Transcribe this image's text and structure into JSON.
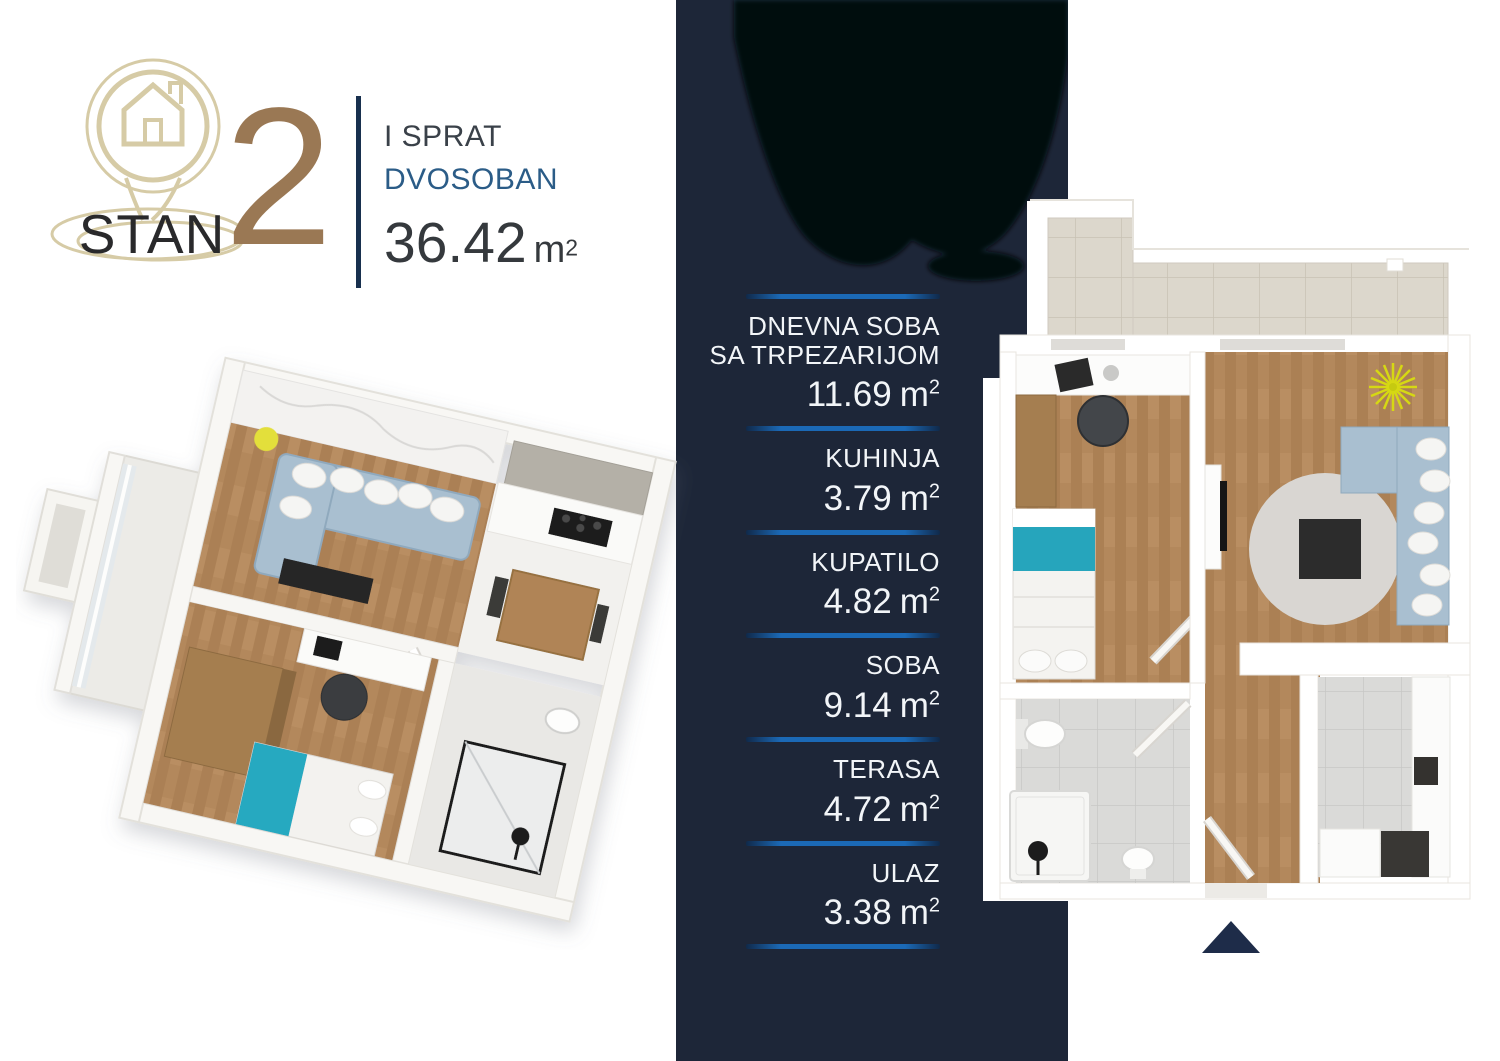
{
  "header": {
    "brand": "STAN",
    "unit_number": "2",
    "floor_label": "I SPRAT",
    "layout_label": "DVOSOBAN",
    "total_area": "36.42",
    "area_unit": "m",
    "area_exp": "2"
  },
  "area_unit": "m",
  "area_exp": "2",
  "rooms": [
    {
      "lines": [
        "DNEVNA SOBA",
        "SA TRPEZARIJOM"
      ],
      "area": "11.69"
    },
    {
      "lines": [
        "KUHINJA"
      ],
      "area": "3.79"
    },
    {
      "lines": [
        "KUPATILO"
      ],
      "area": "4.82"
    },
    {
      "lines": [
        "SOBA"
      ],
      "area": "9.14"
    },
    {
      "lines": [
        "TERASA"
      ],
      "area": "4.72"
    },
    {
      "lines": [
        "ULAZ"
      ],
      "area": "3.38"
    }
  ],
  "colors": {
    "column_navy": "#1d2638",
    "divider_blue": "#1b69b6",
    "unit_number_brown": "#9a7854",
    "logo_beige": "#d6cba6",
    "layout_blue": "#2b5c87",
    "wood_floor": "#b3885c",
    "sofa_blue": "#a9bfd0",
    "bed_teal": "#26a5bc"
  },
  "icons": {
    "logo": "house-pin-icon",
    "marker": "entrance-direction-triangle"
  }
}
